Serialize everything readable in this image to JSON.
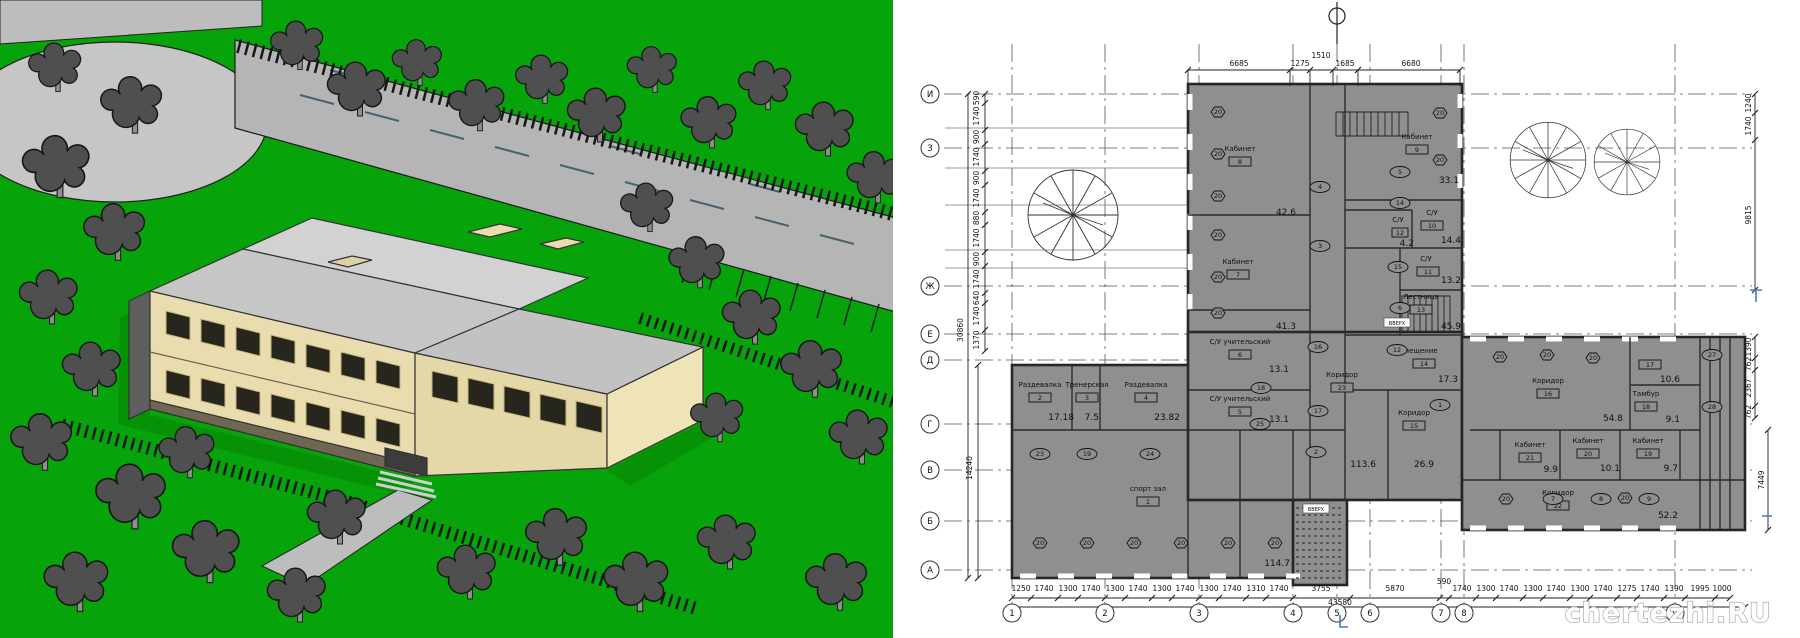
{
  "watermark": "chertezhi.RU",
  "plan": {
    "grid": {
      "rows": [
        "И",
        "З",
        "Ж",
        "Е",
        "Д",
        "Г",
        "В",
        "Б",
        "А"
      ],
      "cols": [
        "1",
        "2",
        "3",
        "4",
        "5",
        "6",
        "7",
        "8",
        "9"
      ]
    },
    "dims": {
      "top": [
        "6685",
        "1275",
        "1510",
        "1685",
        "6680"
      ],
      "left_chain": [
        "590",
        "1740",
        "900",
        "1740",
        "900",
        "1740",
        "880",
        "1740",
        "900",
        "1740",
        "640",
        "1740",
        "1370"
      ],
      "left_total": "30860",
      "left_lower_total": "14240",
      "right_upper": [
        "1240",
        "1740",
        "9815"
      ],
      "right_mid": [
        "1390",
        "762",
        "2367",
        "762"
      ],
      "right_lower_total": "7449",
      "bottom_left": [
        "1250",
        "1740",
        "1300",
        "1740",
        "1300",
        "1740",
        "1300",
        "1740",
        "1300",
        "1740",
        "1310",
        "1740"
      ],
      "bottom_right": [
        "3755",
        "5870",
        "590",
        "1740",
        "1300",
        "1740",
        "1300",
        "1740",
        "1300",
        "1740",
        "1275",
        "1740",
        "1390",
        "1995",
        "1000"
      ],
      "bottom_total": "43580"
    },
    "rooms": [
      {
        "name": "спорт зал",
        "tag": "1",
        "area": "114.7"
      },
      {
        "name": "Раздевалка",
        "tag": "2",
        "area": "17.18"
      },
      {
        "name": "Тренерская",
        "tag": "3",
        "area": "7.5"
      },
      {
        "name": "Раздевалка",
        "tag": "4",
        "area": "23.82"
      },
      {
        "name": "С/У учительский",
        "tag": "5",
        "area": "13.1"
      },
      {
        "name": "С/У учительский",
        "tag": "6",
        "area": "13.1"
      },
      {
        "name": "Кабинет",
        "tag": "7",
        "area": "41.3"
      },
      {
        "name": "Кабинет",
        "tag": "8",
        "area": "42.6"
      },
      {
        "name": "Кабинет",
        "tag": "9",
        "area": "33.1"
      },
      {
        "name": "С/У",
        "tag": "10",
        "area": "14.4"
      },
      {
        "name": "С/У",
        "tag": "11",
        "area": "13.2"
      },
      {
        "name": "С/У",
        "tag": "12",
        "area": "4.2"
      },
      {
        "name": "Лестница",
        "tag": "13",
        "area": "45.9"
      },
      {
        "name": "Помещение",
        "tag": "14",
        "area": "17.3"
      },
      {
        "name": "Коридор",
        "tag": "15",
        "area": "26.9"
      },
      {
        "name": "Коридор",
        "tag": "16",
        "area": "54.8"
      },
      {
        "name": "",
        "tag": "17",
        "area": "10.6"
      },
      {
        "name": "Тамбур",
        "tag": "18",
        "area": "9.1"
      },
      {
        "name": "Кабинет",
        "tag": "19",
        "area": "9.7"
      },
      {
        "name": "Кабинет",
        "tag": "20",
        "area": "10.1"
      },
      {
        "name": "Кабинет",
        "tag": "21",
        "area": "9.9"
      },
      {
        "name": "Коридор",
        "tag": "22",
        "area": "52.2"
      },
      {
        "name": "Коридор",
        "tag": "23",
        "area": ""
      }
    ],
    "loose_areas": {
      "hall": "113.6"
    },
    "door_tags": [
      "4",
      "3",
      "5",
      "14",
      "15",
      "6",
      "16",
      "17",
      "18",
      "25",
      "12",
      "1",
      "2",
      "23",
      "19",
      "24",
      "27",
      "28",
      "7",
      "8",
      "9"
    ],
    "window_tag": "20",
    "stair_label": "ВВЕРХ"
  },
  "colors": {
    "grass": "#07a30a",
    "road": "#b5b5b5",
    "tree": "#4f4f4f",
    "wall_fill": "#8f8f8f",
    "facade": "#e9ddb0",
    "roof": "#c7c7c7",
    "blue_mark": "#4a74c9"
  }
}
